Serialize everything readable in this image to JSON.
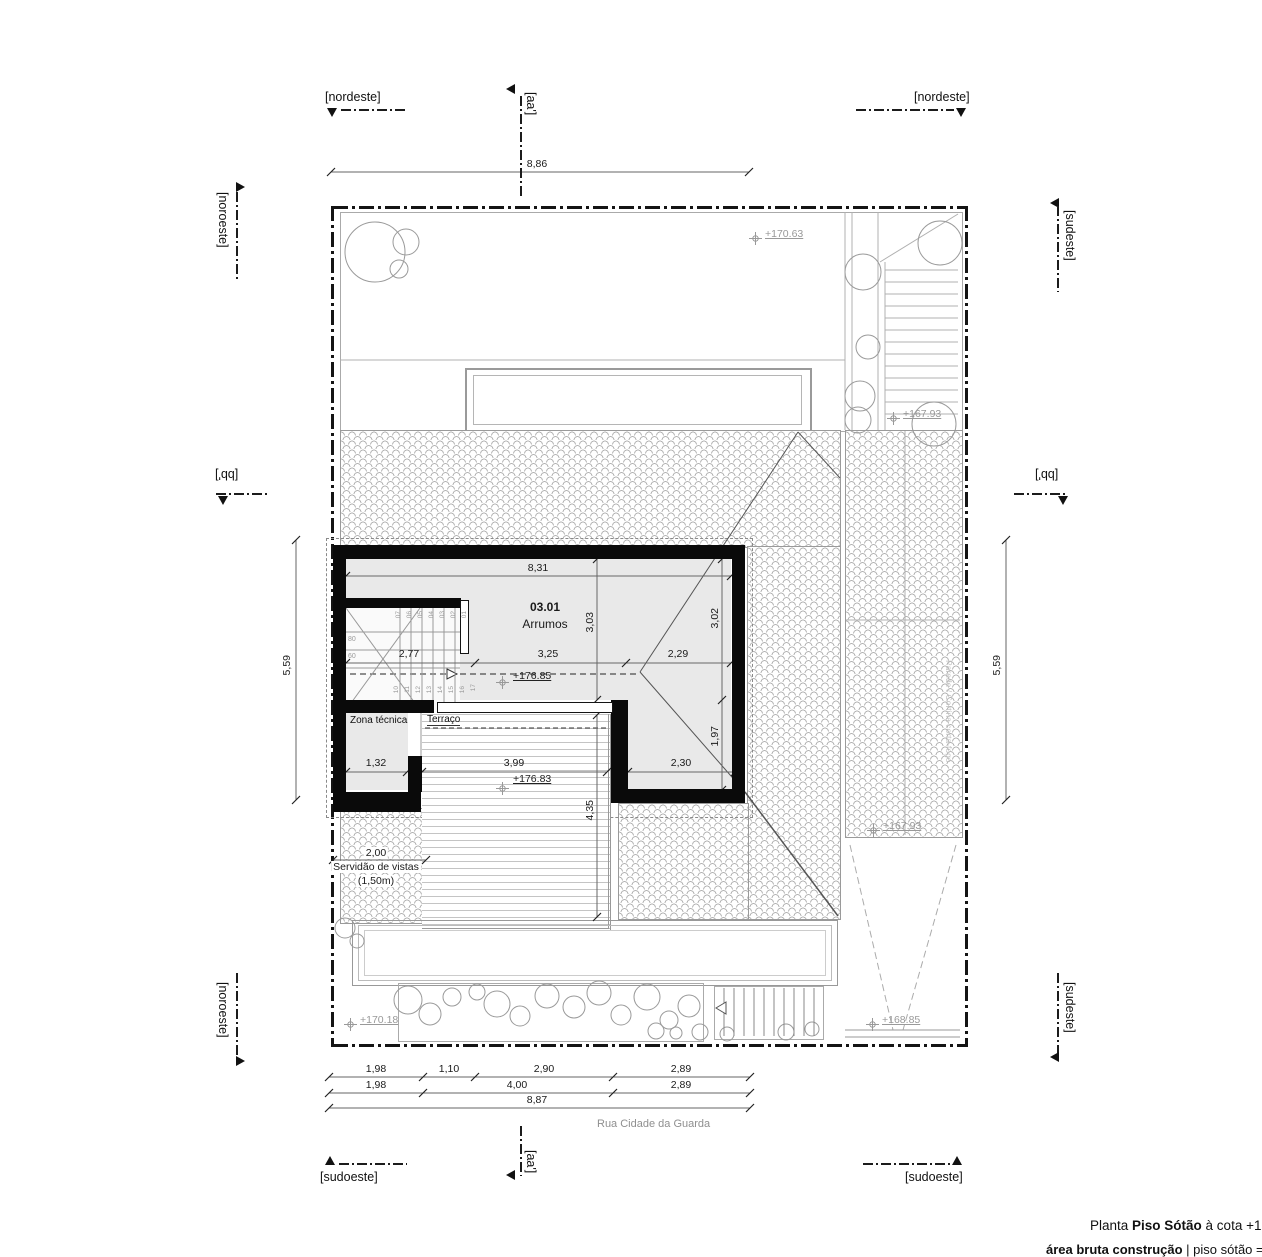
{
  "colors": {
    "wall": "#0a0a0a",
    "floor": "#e9e9e9",
    "annotation_gray": "#999999"
  },
  "section_labels": {
    "nordeste_left": "[nordeste]",
    "nordeste_right": "[nordeste]",
    "aa_top": "[aa']",
    "aa_bottom": "[aa']",
    "noroeste_top": "[noroeste]",
    "noroeste_bottom": "[noroeste]",
    "sudeste_top": "[sudeste]",
    "sudeste_bottom": "[sudeste]",
    "bb_left": "[bb']",
    "bb_right": "[bb']",
    "sudoeste_left": "[sudoeste]",
    "sudoeste_right": "[sudoeste]"
  },
  "room": {
    "number": "03.01",
    "name": "Arrumos"
  },
  "texts": {
    "zona_tecnica": "Zona técnica",
    "terraco": "Terraço",
    "servidao_1": "Servidão de vistas",
    "servidao_2": "(1,50m)",
    "street": "Rua Cidade da Guarda",
    "firewall": "Parede / Cortina corta-fogo"
  },
  "elevations": {
    "top_garden": "+170.63",
    "stairs_top": "+167.93",
    "attic": "+176.85",
    "terrace": "+176.83",
    "roof_right": "+167.93",
    "garden_bottom": "+170.18",
    "ramp": "+168.85"
  },
  "dims": {
    "site_top": "8,86",
    "attic_width": "8,31",
    "attic_left": "3,03",
    "attic_right": "3,02",
    "attic_lower_right": "1,97",
    "stair_w": "2,77",
    "attic_mid": "3,25",
    "attic_r": "2,29",
    "zona": "1,32",
    "terrace_w": "3,99",
    "lower_room": "2,30",
    "terrace_h": "4,35",
    "side_l": "5,59",
    "side_r": "5,59",
    "servidao": "2,00",
    "r1": [
      "1,98",
      "1,10",
      "2,90",
      "2,89"
    ],
    "r2": [
      "1,98",
      "4,00",
      "2,89"
    ],
    "total": "8,87"
  },
  "stair": {
    "top": [
      "07",
      "06",
      "05",
      "04",
      "03",
      "02",
      "01"
    ],
    "bottom": [
      "10",
      "11",
      "12",
      "13",
      "14",
      "15",
      "16",
      "17"
    ],
    "w1": "80",
    "w2": "60"
  },
  "title": {
    "p1": "Planta ",
    "p2": "Piso Sótão",
    "p3": " à cota +17",
    "p4": "área bruta construção",
    "p5": " | piso sótão = 03"
  }
}
